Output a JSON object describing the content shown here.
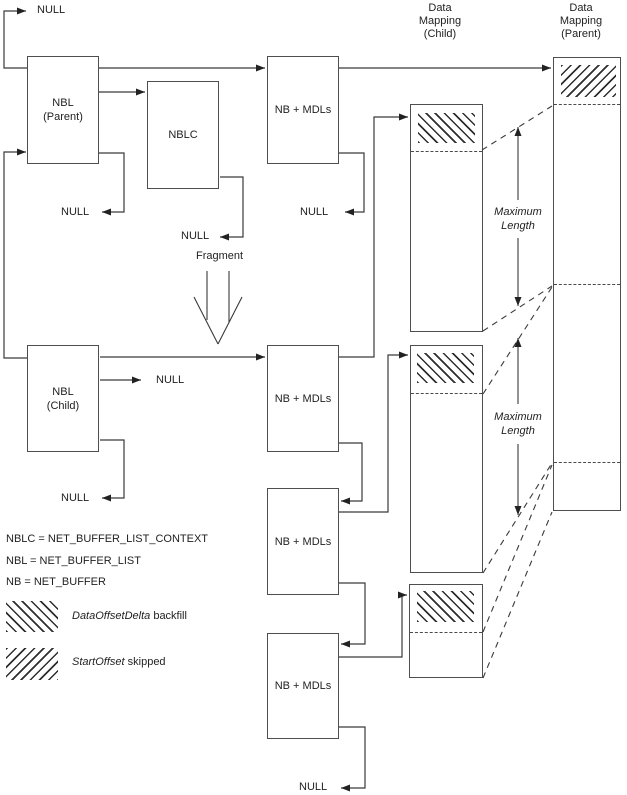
{
  "diagram": {
    "headers": {
      "child": [
        "Data",
        "Mapping",
        "(Child)"
      ],
      "parent": [
        "Data",
        "Mapping",
        "(Parent)"
      ]
    },
    "boxes": {
      "nbl_parent_line1": "NBL",
      "nbl_parent_line2": "(Parent)",
      "nbl_child_line1": "NBL",
      "nbl_child_line2": "(Child)",
      "nblc": "NBLC",
      "nb_mdls": "NB + MDLs"
    },
    "labels": {
      "null": "NULL",
      "fragment": "Fragment",
      "max_len_line1": "Maximum",
      "max_len_line2": "Length"
    },
    "legend": {
      "abbrev1": "NBLC = NET_BUFFER_LIST_CONTEXT",
      "abbrev2": "NBL = NET_BUFFER_LIST",
      "abbrev3": "NB = NET_BUFFER",
      "backfill_term": "DataOffsetDelta",
      "backfill_rest": " backfill",
      "skipped_term": "StartOffset",
      "skipped_rest": " skipped"
    },
    "colors": {
      "line": "#3a3a3a",
      "border": "#4e4e4e",
      "text": "#1f1f1f",
      "background": "#ffffff"
    }
  }
}
